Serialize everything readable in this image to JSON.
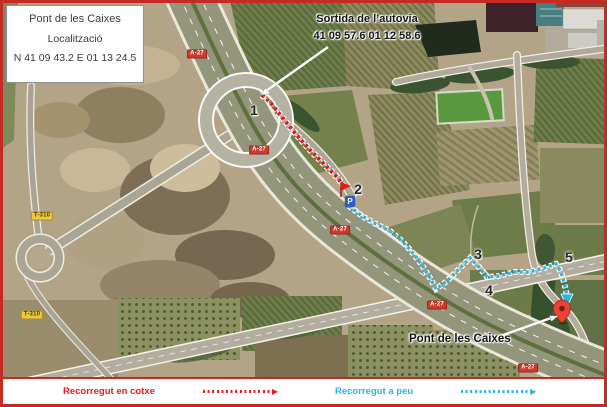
{
  "info_box": {
    "title": "Pont de les Caixes",
    "subtitle": "Localització",
    "coords": "N 41 09 43.2 E 01 13 24.5"
  },
  "exit_label": {
    "title": "Sortida de l’autovia",
    "coords": "41 09 57.6  01 12 58.6"
  },
  "destination_label": "Pont de les Caixes",
  "waypoints": [
    {
      "label": "1"
    },
    {
      "label": "2"
    },
    {
      "label": "3"
    },
    {
      "label": "4"
    },
    {
      "label": "5"
    }
  ],
  "markers": {
    "parking": "P"
  },
  "road_badges": {
    "a27": "A-27",
    "t310": "T-310"
  },
  "legend": {
    "car": {
      "label": "Recorregut en cotxe",
      "color": "#e02020",
      "arrow": "▶"
    },
    "walk": {
      "label": "Recorregut a peu",
      "color": "#2bb3e6",
      "arrow": "▶"
    }
  },
  "routes": {
    "car": {
      "points": "262,95 270,102 281,116 295,133 310,150 324,164 337,177 345,188"
    },
    "walk": {
      "points": "349,206 362,216 376,224 390,231 402,241 412,252 422,265 430,278 436,289 447,281 459,269 470,258 479,267 487,277 499,276 514,272 529,272 544,268 556,264 561,272 564,282 566,291 567,296"
    }
  }
}
